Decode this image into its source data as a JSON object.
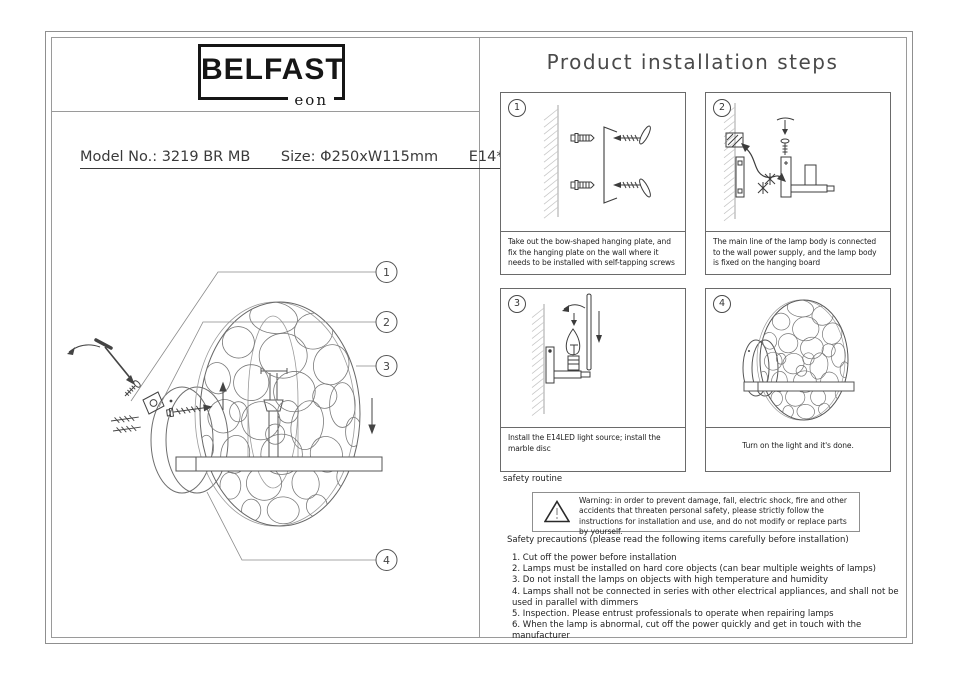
{
  "page": {
    "brand": {
      "name": "BELFAST",
      "sub": "eon"
    },
    "model_line": {
      "model": "Model No.: 3219 BR MB",
      "size": "Size: Φ250xW115mm",
      "lamp": "E14*1"
    },
    "title": "Product installation steps",
    "steps": [
      {
        "num": "1",
        "caption": "Take out the bow-shaped hanging plate, and fix the hanging plate on the wall where it needs to be installed with self-tapping screws"
      },
      {
        "num": "2",
        "caption": "The main line of the lamp body is connected to the wall power supply, and the lamp body is fixed on the hanging board"
      },
      {
        "num": "3",
        "caption": "Install the E14LED light source; install the marble disc"
      },
      {
        "num": "4",
        "caption": "Turn on the light and it's done."
      }
    ],
    "callouts": [
      "1",
      "2",
      "3",
      "4"
    ],
    "safety_routine_label": "safety routine",
    "warning": "Warning: in order to prevent damage, fall, electric shock, fire and other accidents that threaten personal safety, please strictly follow the instructions for installation and use, and do not modify or replace parts by yourself.",
    "precautions_title": "Safety precautions (please read the following items carefully before installation)",
    "precautions": [
      "1. Cut off the power before installation",
      "2. Lamps must be installed on hard core objects (can bear multiple weights of lamps)",
      "3. Do not install the lamps on objects with high temperature and humidity",
      "4. Lamps shall not be connected in series with other electrical appliances, and shall not be used in parallel with dimmers",
      "5. Inspection. Please entrust professionals to operate when repairing lamps",
      "6. When the lamp is abnormal, cut off the power quickly and get in touch with the manufacturer"
    ]
  },
  "colors": {
    "ink": "#2e2e2e",
    "line_gray": "#9a9a9a",
    "drawing_line": "#555555"
  }
}
